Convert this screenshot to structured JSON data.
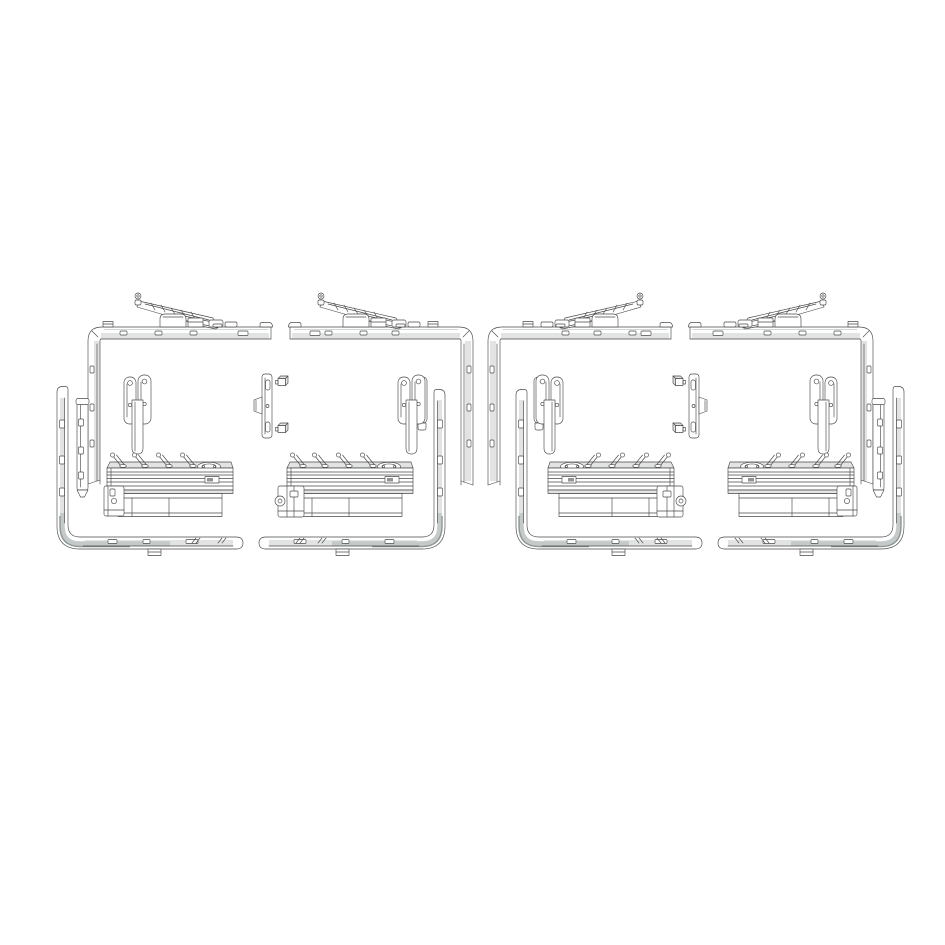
{
  "canvas": {
    "width": 945,
    "height": 945,
    "background": "#ffffff"
  },
  "figure": {
    "kind": "technical-line-drawing",
    "subject": "tilt-and-turn window hardware fitting sets",
    "set_count": 4,
    "arrangement": "two left-hand sets on the left, two mirrored right-hand sets on the right"
  },
  "colors": {
    "background": "#ffffff",
    "line": "#4a4a4a",
    "shade_light": "#e2e4e4",
    "shade_mid": "#c4c9c9",
    "shade_dark": "#8f9595"
  },
  "layout": {
    "drawing_top": 288,
    "left_half_x": 40,
    "right_half_x": 485,
    "half_width": 436,
    "half_height": 276,
    "mirror_axis_x": 480
  },
  "groups": [
    {
      "id": "set-1",
      "orientation": "left-hand",
      "components": [
        "top-corner-rail",
        "scissor-stay-arm",
        "inner-lock-rail",
        "bottom-corner-rail",
        "window-handle",
        "gear-drive-unit",
        "gear-connector-bracket",
        "striker-plate",
        "locking-keeps"
      ]
    },
    {
      "id": "set-2",
      "orientation": "left-hand-opposed",
      "components": [
        "top-corner-rail",
        "scissor-stay-arm",
        "inner-lock-rail",
        "bottom-corner-rail",
        "window-handle",
        "gear-drive-unit",
        "gear-motor-connector"
      ]
    },
    {
      "id": "set-3",
      "orientation": "right-hand-opposed",
      "components": [
        "top-corner-rail",
        "scissor-stay-arm",
        "inner-lock-rail",
        "bottom-corner-rail",
        "window-handle",
        "gear-drive-unit",
        "gear-motor-connector"
      ]
    },
    {
      "id": "set-4",
      "orientation": "right-hand",
      "components": [
        "top-corner-rail",
        "scissor-stay-arm",
        "inner-lock-rail",
        "bottom-corner-rail",
        "window-handle",
        "gear-drive-unit",
        "gear-connector-bracket",
        "striker-plate",
        "locking-keeps"
      ]
    }
  ]
}
